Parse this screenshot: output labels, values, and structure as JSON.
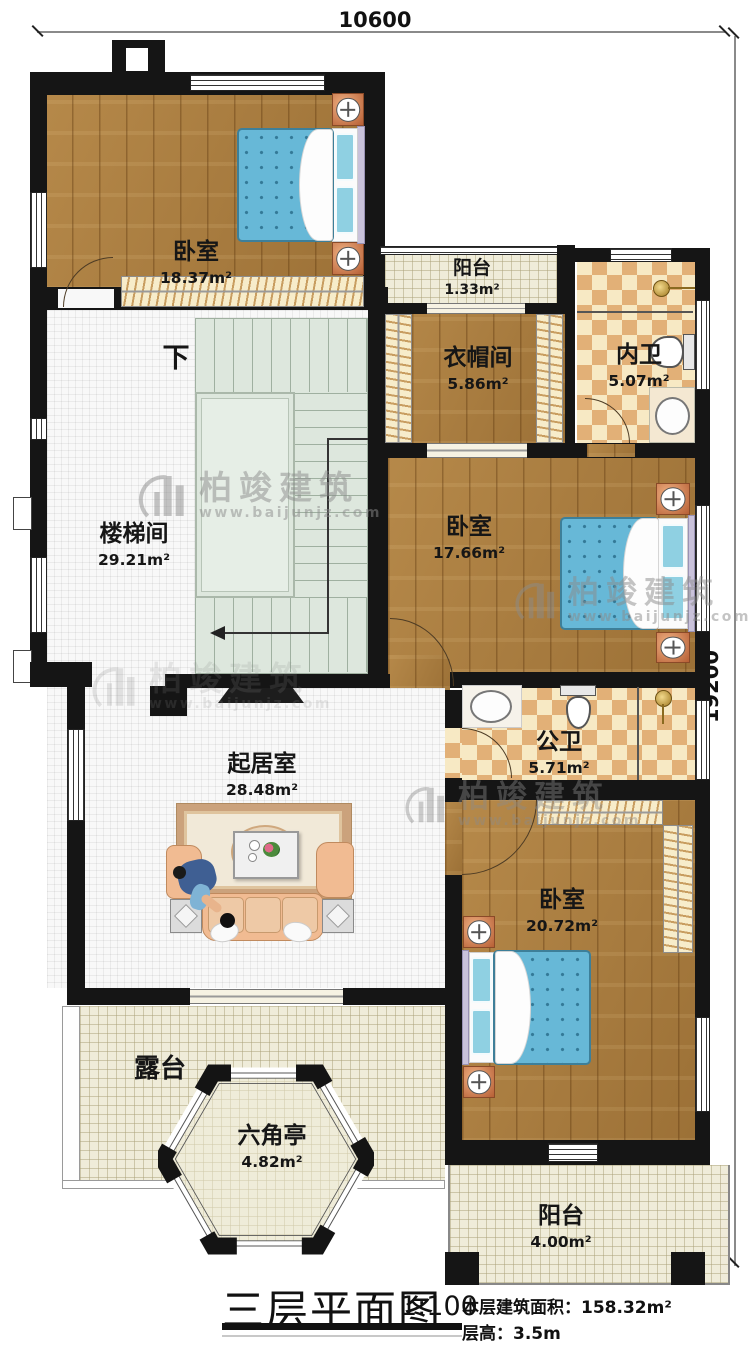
{
  "dimensions": {
    "top": "10600",
    "right": "19200"
  },
  "watermark": {
    "brand": "柏竣建筑",
    "url": "www.baijunjz.com"
  },
  "rooms": {
    "bedroom1": {
      "name": "卧室",
      "area": "18.37m²"
    },
    "balcony_top": {
      "name": "阳台",
      "area": "1.33m²"
    },
    "cloakroom": {
      "name": "衣帽间",
      "area": "5.86m²"
    },
    "ensuite": {
      "name": "内卫",
      "area": "5.07m²"
    },
    "stair_hall": {
      "name": "楼梯间",
      "area": "29.21m²",
      "down": "下"
    },
    "bedroom2": {
      "name": "卧室",
      "area": "17.66m²"
    },
    "public_bath": {
      "name": "公卫",
      "area": "5.71m²"
    },
    "living_room": {
      "name": "起居室",
      "area": "28.48m²"
    },
    "bedroom3": {
      "name": "卧室",
      "area": "20.72m²"
    },
    "terrace": {
      "name": "露台"
    },
    "pavilion": {
      "name": "六角亭",
      "area": "4.82m²"
    },
    "balcony_bottom": {
      "name": "阳台",
      "area": "4.00m²"
    }
  },
  "title": {
    "main": "三层平面图",
    "scale": "1:100",
    "area_label": "本层建筑面积：",
    "area_value": "158.32m²",
    "height_label": "层高：",
    "height_value": "3.5m"
  },
  "colors": {
    "wall": "#151515",
    "wood": "#a97c3e",
    "tile": "#efecd9",
    "checker_dark": "#e2b077",
    "checker_light": "#f7e9c4",
    "stairs": "#dde7dd",
    "bed": "#67b8d7",
    "copper": "#c87749"
  }
}
